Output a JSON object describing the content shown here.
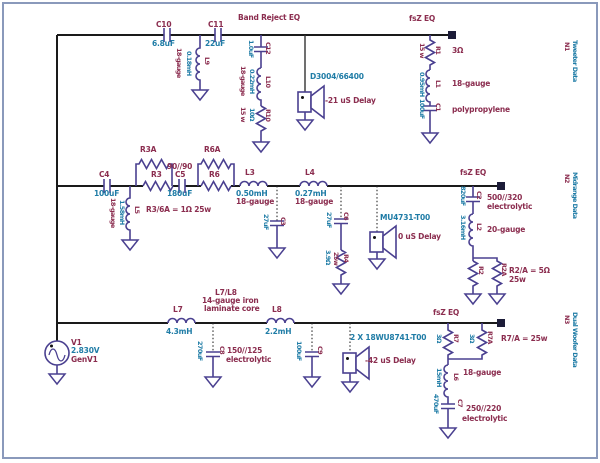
{
  "colors": {
    "designator": "#8b2d4f",
    "value": "#1f7ca6",
    "wire": "#4a4090",
    "trunk": "#1a1a1a",
    "border": "#8a99bb"
  },
  "source": {
    "ref": "V1",
    "voltage": "2.830V",
    "name": "GenV1"
  },
  "tweeter": {
    "band_reject_label": "Band Reject EQ",
    "fsz_label": "fsZ EQ",
    "net_id": "N1",
    "net_name": "Tweeter Data",
    "c10": {
      "ref": "C10",
      "value": "6.8uF"
    },
    "c11": {
      "ref": "C11",
      "value": "22uF"
    },
    "l9": {
      "ref": "L9",
      "value": "0.18mH",
      "note": "18-gauge"
    },
    "c12": {
      "ref": "C12",
      "value": "1.0uF"
    },
    "l10": {
      "ref": "L10",
      "value": "0.22mH",
      "note": "18-gauge"
    },
    "r10": {
      "ref": "R10",
      "value": "10Ω",
      "note": "15 w"
    },
    "driver": {
      "model": "D3004/66400",
      "delay": "-21 uS Delay"
    },
    "r1": {
      "ref": "R1",
      "value": "3Ω",
      "note": "15 w"
    },
    "l1": {
      "ref": "L1",
      "value": "0.95mH",
      "note": "18-gauge"
    },
    "c1": {
      "ref": "C1",
      "value": "100uF",
      "note": "polypropylene"
    }
  },
  "midrange": {
    "fsz_label": "fsZ EQ",
    "net_id": "N2",
    "net_name": "Midrange Data",
    "c4": {
      "ref": "C4",
      "value": "100uF"
    },
    "l5": {
      "ref": "L5",
      "value": "1.58mH",
      "note": "18-gauge"
    },
    "r3": {
      "ref": "R3"
    },
    "r3a": {
      "ref": "R3A"
    },
    "parallel_note": "90//90",
    "c5": {
      "ref": "C5",
      "value": "180uF"
    },
    "r6": {
      "ref": "R6"
    },
    "r6a": {
      "ref": "R6A"
    },
    "resistor_note": "R3/6A = 1Ω 25w",
    "l3": {
      "ref": "L3",
      "value": "0.50mH",
      "note": "18-gauge"
    },
    "c3": {
      "ref": "C3",
      "value": "27uF"
    },
    "l4": {
      "ref": "L4",
      "value": "0.27mH",
      "note": "18-gauge"
    },
    "c6": {
      "ref": "C6",
      "value": "27uF"
    },
    "r4": {
      "ref": "R4",
      "value": "3.9Ω",
      "note": "25w"
    },
    "driver": {
      "model": "MU4731-T00",
      "delay": "0 uS Delay"
    },
    "c2": {
      "ref": "C2",
      "value": "820uF",
      "note1": "500//320",
      "note2": "electrolytic"
    },
    "l2": {
      "ref": "L2",
      "value": "3.16mH",
      "note": "20-gauge"
    },
    "r2": {
      "ref": "R2"
    },
    "r2a": {
      "ref": "R2A"
    },
    "r2_note1": "R2/A = 5Ω",
    "r2_note2": "25w"
  },
  "woofer": {
    "fsz_label": "fsZ EQ",
    "net_id": "N3",
    "net_name": "Dual Woofer Data",
    "l7": {
      "ref": "L7",
      "value": "4.3mH"
    },
    "coil_note1": "L7/L8",
    "coil_note2": "14-gauge iron",
    "coil_note3": "laminate core",
    "c8": {
      "ref": "C8",
      "value": "270uF",
      "note1": "150//125",
      "note2": "electrolytic"
    },
    "l8": {
      "ref": "L8",
      "value": "2.2mH"
    },
    "c9": {
      "ref": "C9",
      "value": "100uF"
    },
    "driver": {
      "model": "2 X 18WU8741-T00",
      "delay": "-42 uS Delay"
    },
    "r7": {
      "ref": "R7",
      "value": "3Ω"
    },
    "r7a": {
      "ref": "R7A",
      "value": "3Ω"
    },
    "r7_note": "R7/A = 25w",
    "l6": {
      "ref": "L6",
      "value": "15mH",
      "note": "18-gauge"
    },
    "c7": {
      "ref": "C7",
      "value": "470uF",
      "note1": "250//220",
      "note2": "electrolytic"
    }
  }
}
